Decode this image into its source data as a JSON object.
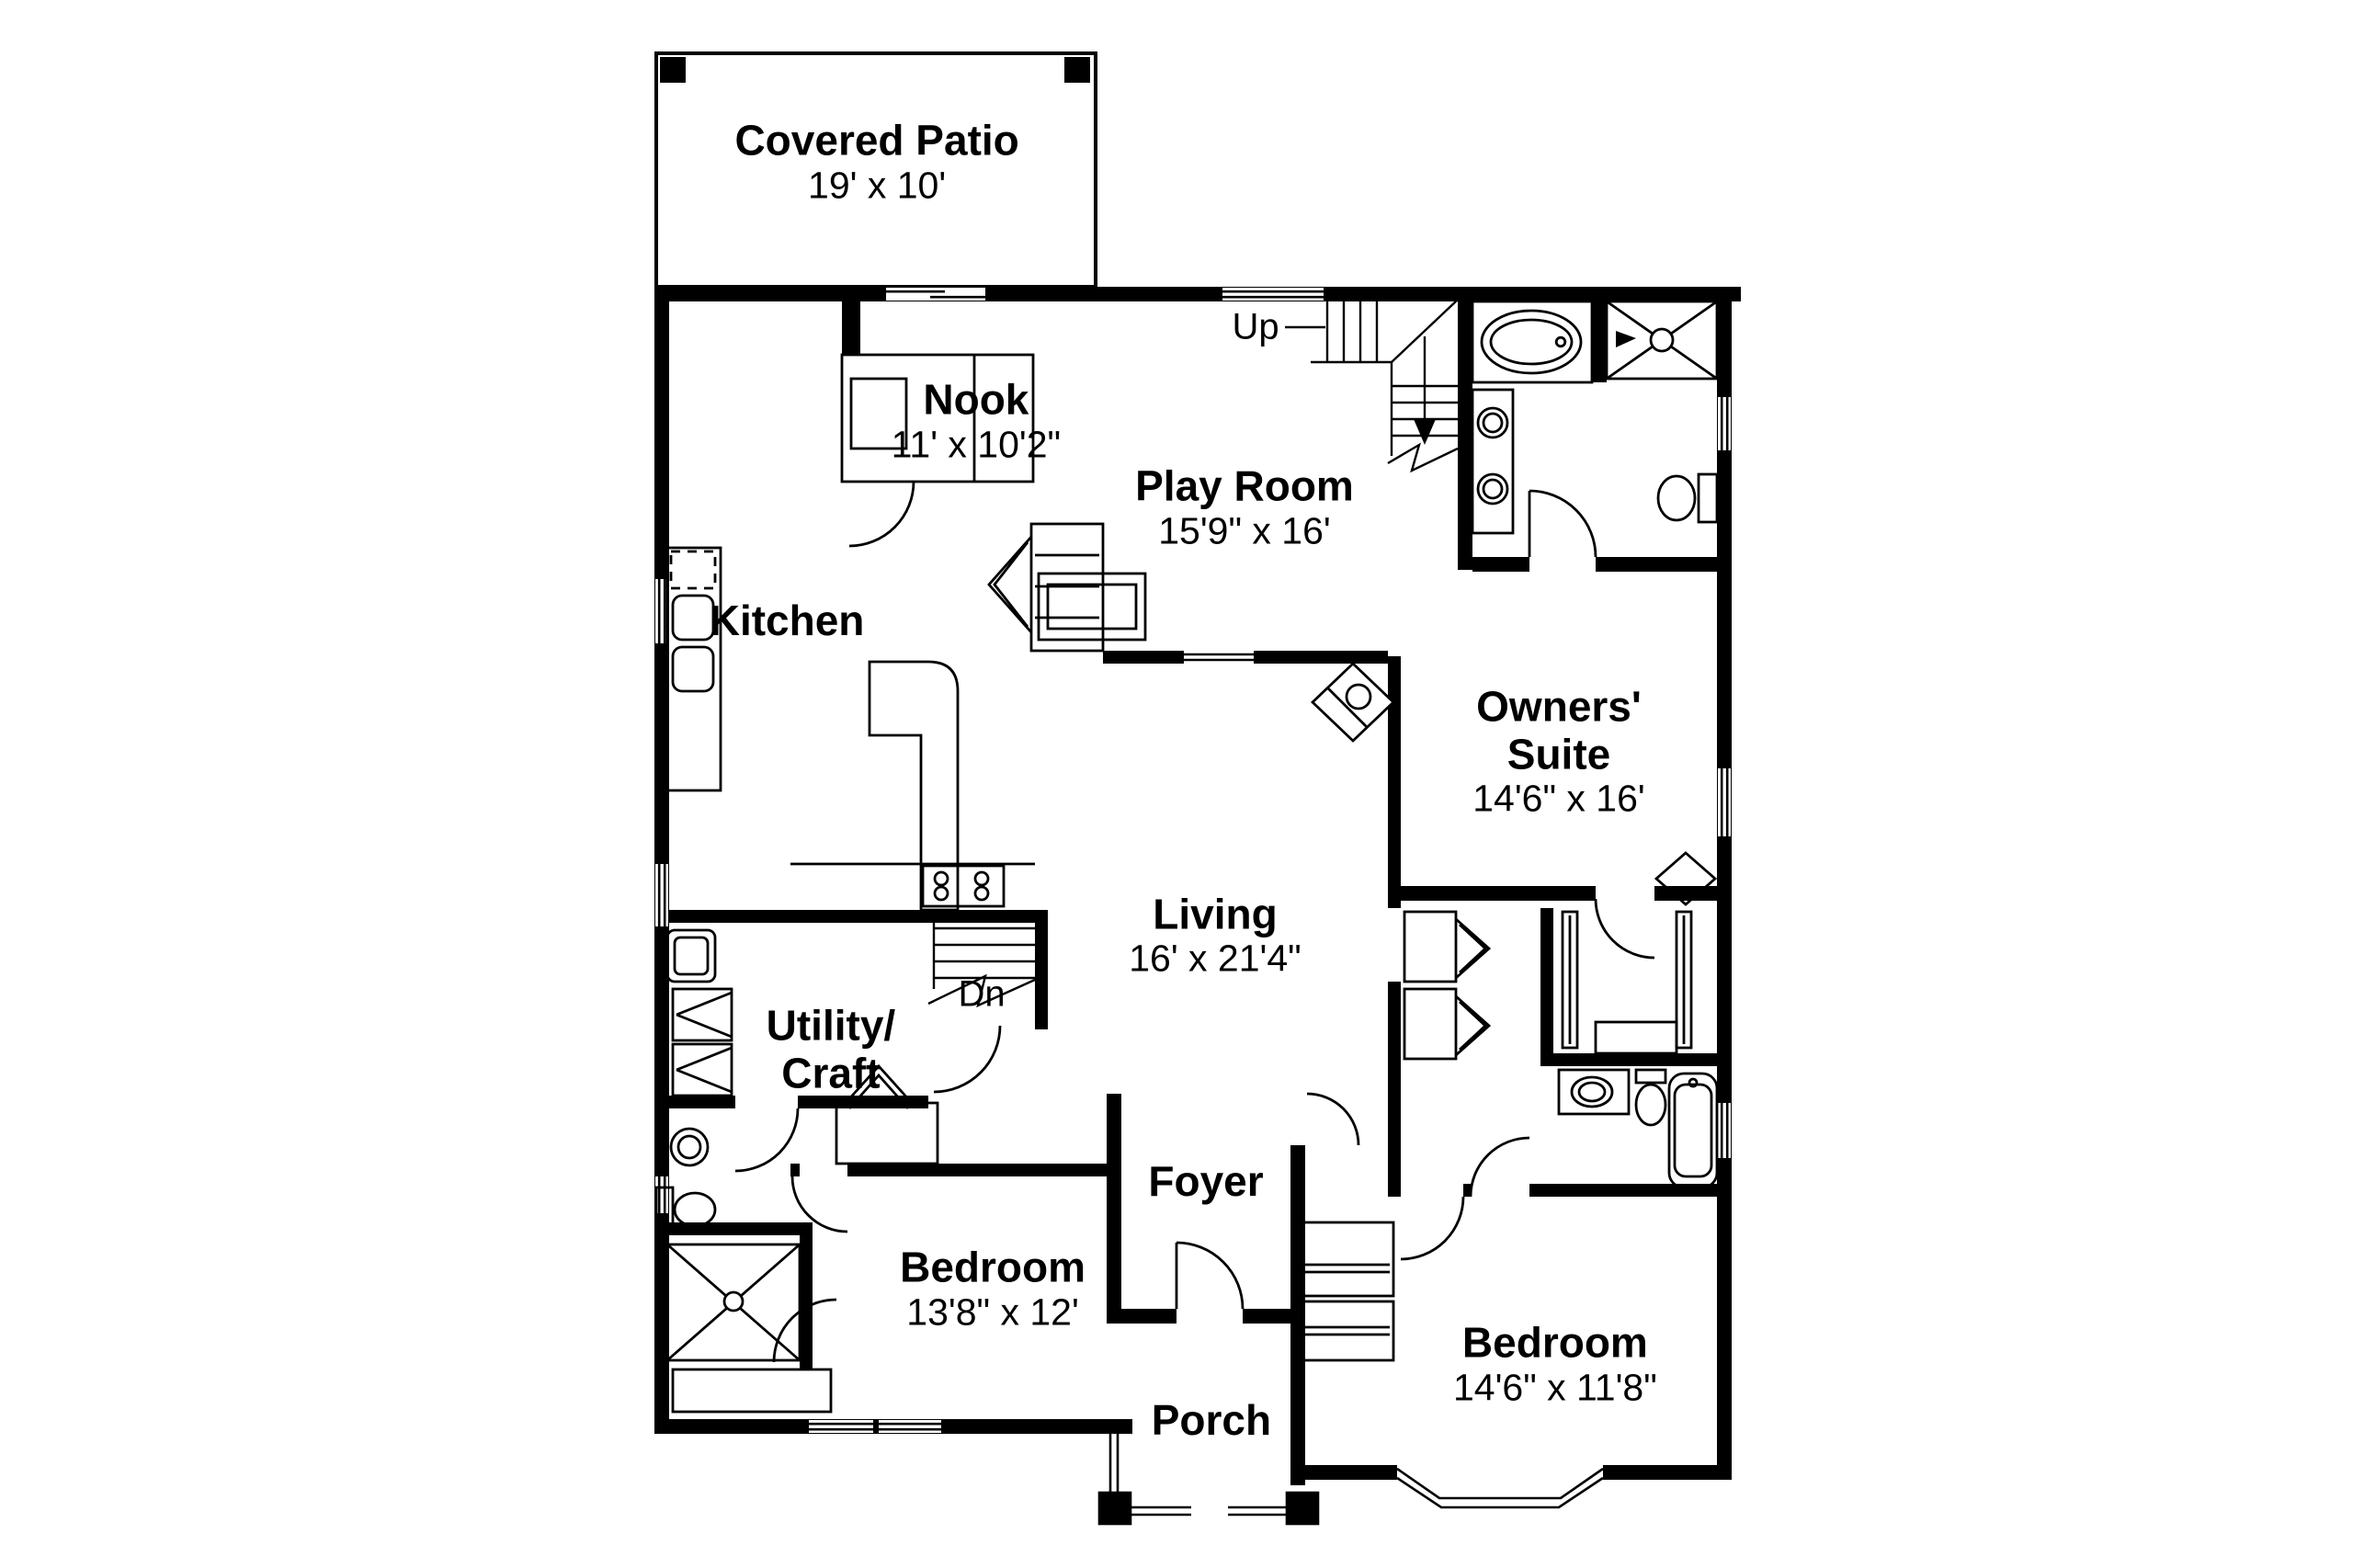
{
  "plan": {
    "title": "House first-floor plan",
    "rooms": {
      "covered_patio": {
        "name": "Covered Patio",
        "dims": "19' x 10'"
      },
      "nook": {
        "name": "Nook",
        "dims": "11' x 10'2\""
      },
      "play_room": {
        "name": "Play Room",
        "dims": "15'9\" x 16'"
      },
      "kitchen": {
        "name": "Kitchen"
      },
      "owners_suite": {
        "name": "Owners' Suite",
        "dims": "14'6\" x 16'"
      },
      "living": {
        "name": "Living",
        "dims": "16' x 21'4\""
      },
      "utility_craft": {
        "line1": "Utility/",
        "line2": "Craft"
      },
      "foyer": {
        "name": "Foyer"
      },
      "bedroom_front": {
        "name": "Bedroom",
        "dims": "13'8\" x 12'"
      },
      "bedroom_side": {
        "name": "Bedroom",
        "dims": "14'6\" x 11'8\""
      },
      "porch": {
        "name": "Porch"
      }
    },
    "stair_labels": {
      "up": "Up",
      "down": "Dn"
    },
    "colors": {
      "wall": "#000000",
      "background": "#ffffff",
      "line": "#000000"
    }
  }
}
